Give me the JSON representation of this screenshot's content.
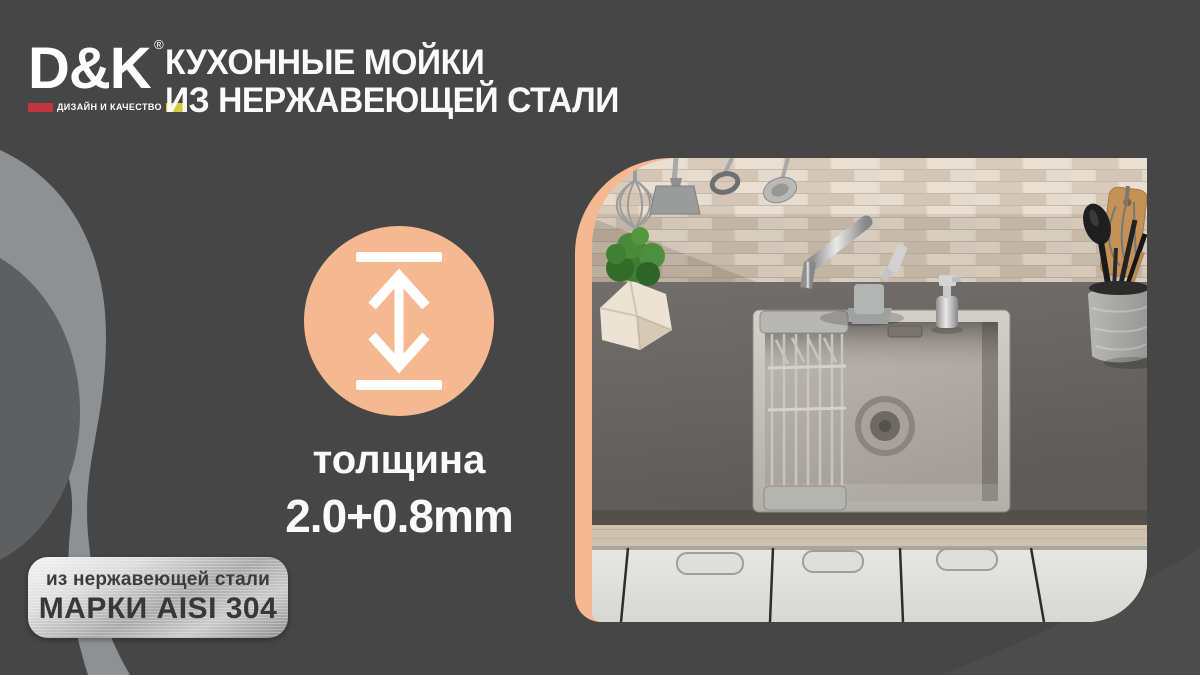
{
  "brand": {
    "name": "D&K",
    "registered_mark": "®",
    "tagline": "ДИЗАЙН И КАЧЕСТВО"
  },
  "title": {
    "line1": "КУХОННЫЕ МОЙКИ",
    "line2": "ИЗ НЕРЖАВЕЮЩЕЙ СТАЛИ"
  },
  "feature": {
    "icon": "thickness-double-arrow-icon",
    "label": "толщина",
    "value": "2.0+0.8mm"
  },
  "badge": {
    "line1": "из нержавеющей стали",
    "line2": "МАРКИ AISI 304"
  },
  "photo": {
    "subject": "stainless-steel-kitchen-sink-scene"
  },
  "colors": {
    "background": "#464646",
    "accent_peach": "#F6B891",
    "swoosh_light": "#8E9194",
    "swoosh_medium": "#5E5F61",
    "logo_red": "#C2373D",
    "logo_yellow": "#D5CB3A",
    "badge_text": "#3C3C3C",
    "text_white": "#FAFAFA"
  }
}
